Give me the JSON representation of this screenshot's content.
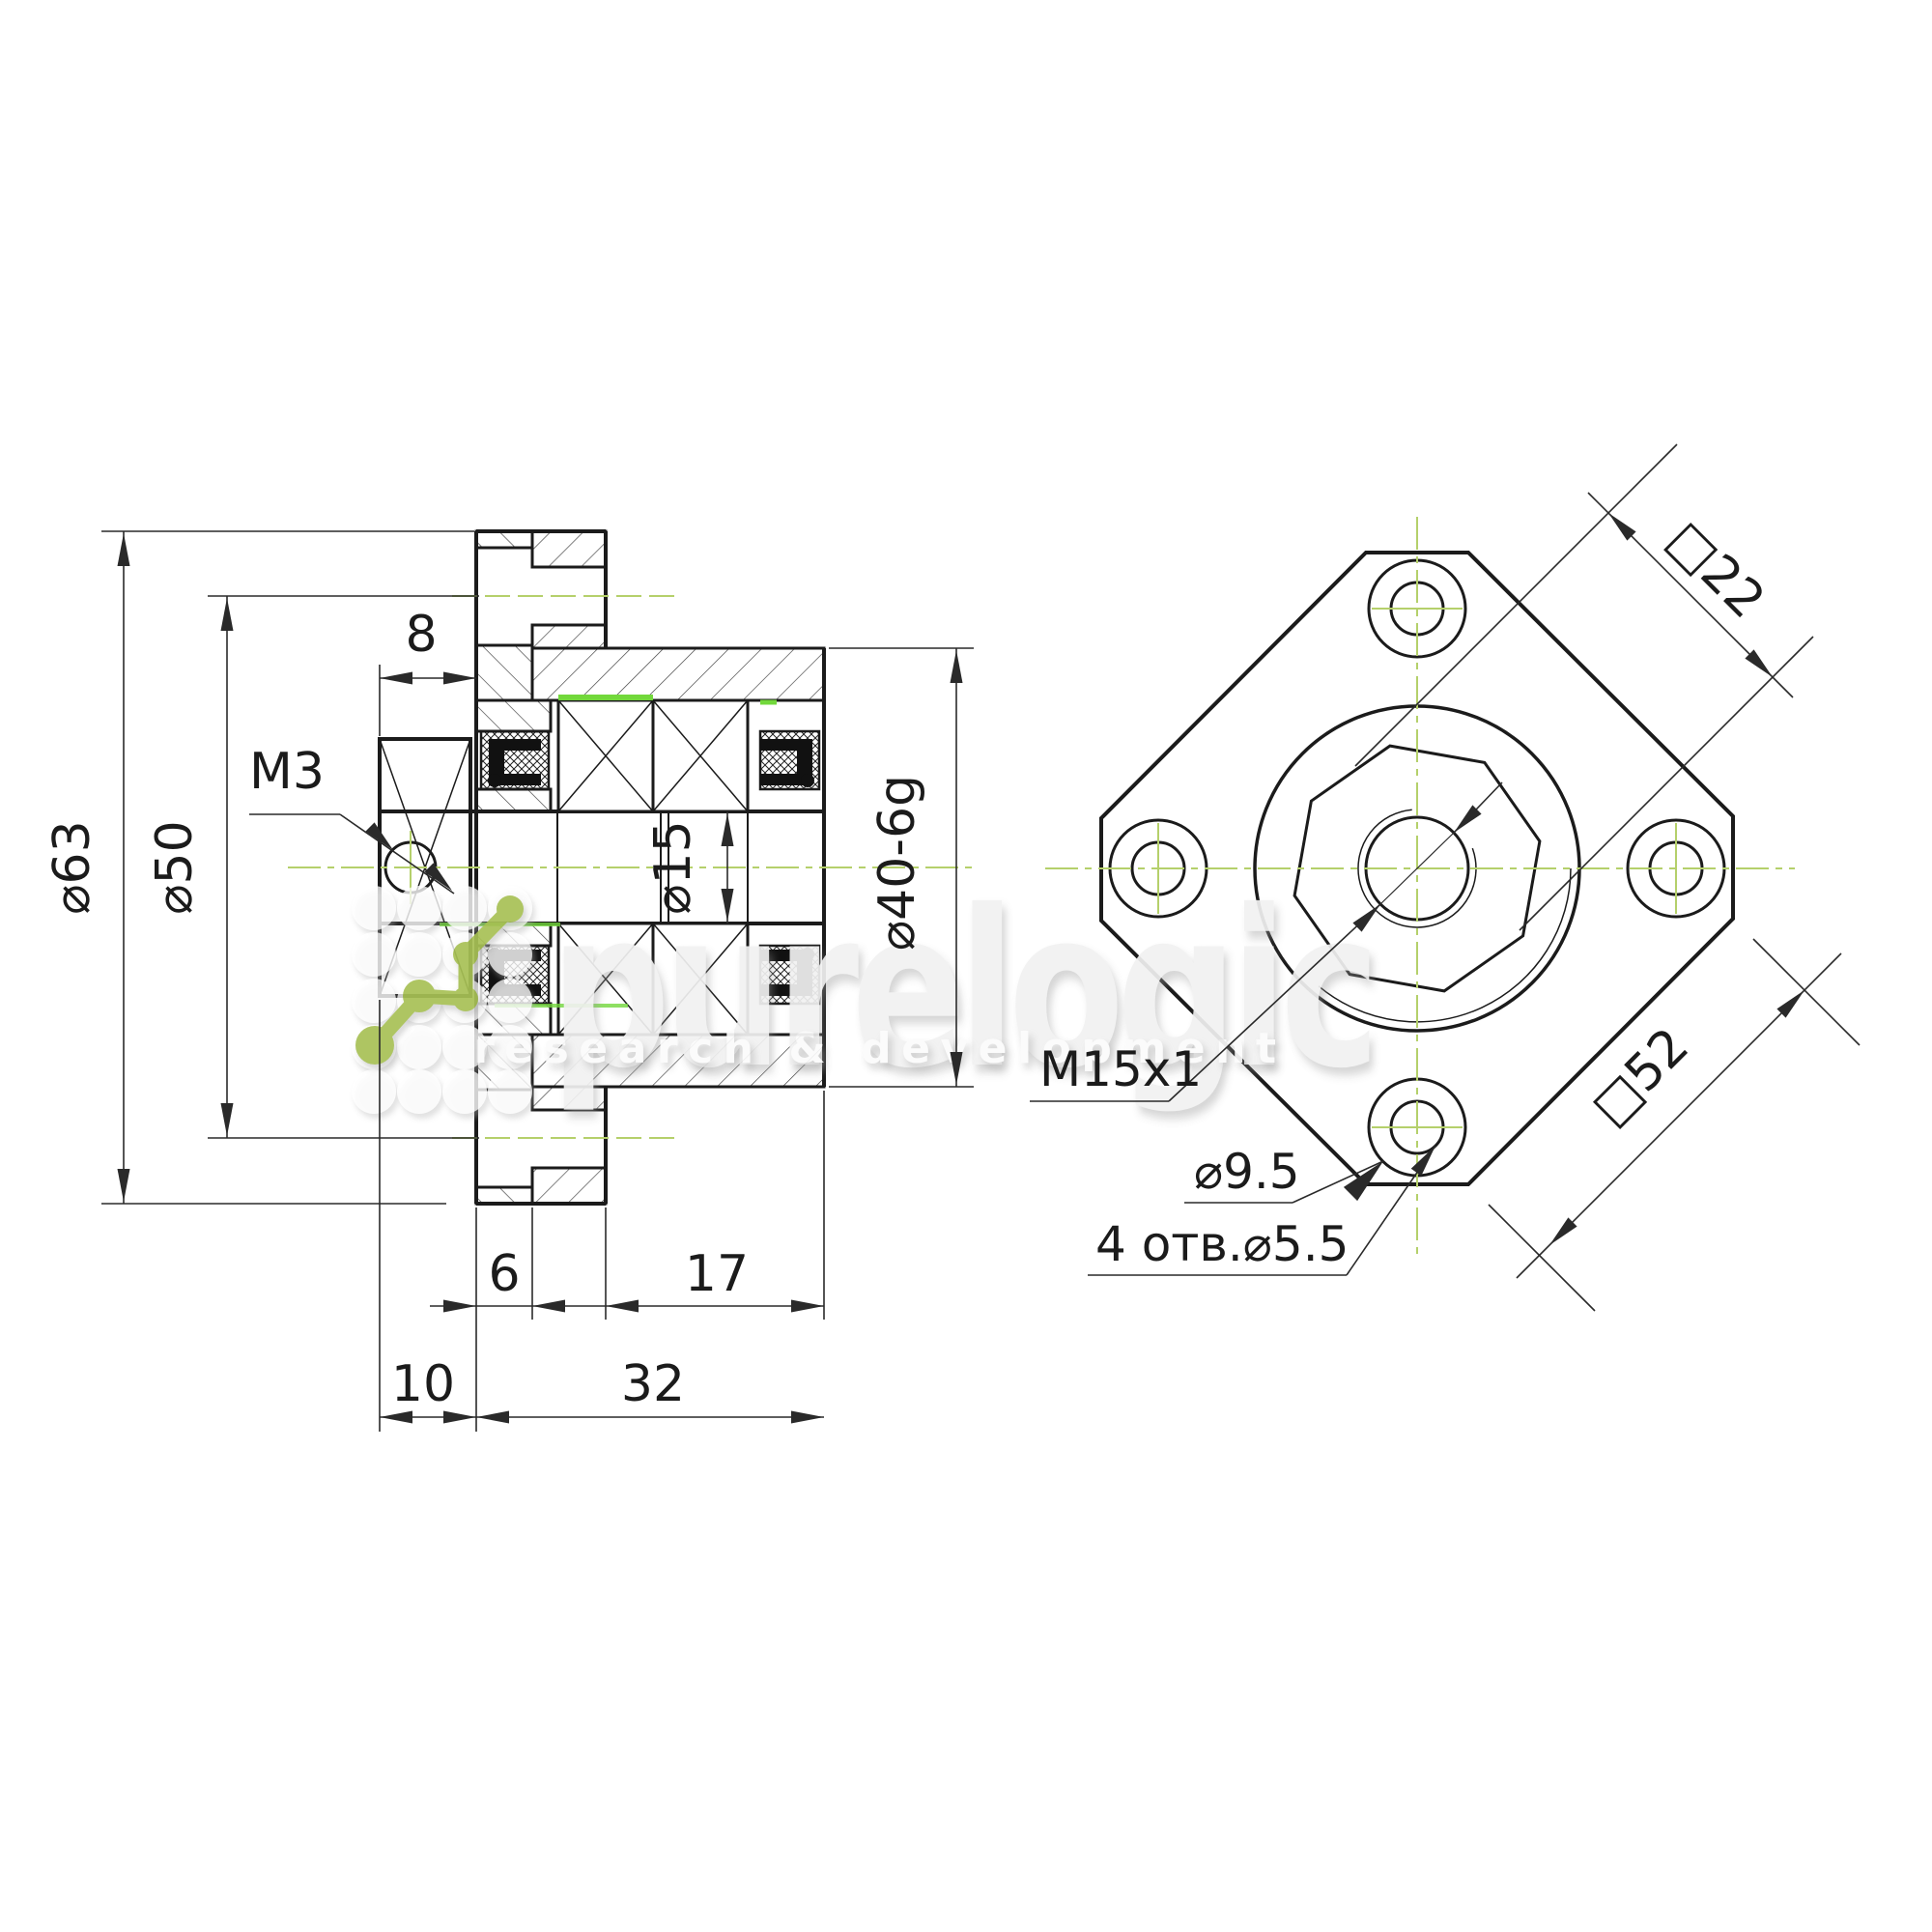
{
  "colors": {
    "background": "#ffffff",
    "line": "#1b1b1b",
    "dimension": "#2a2a2a",
    "centerline_green": "#b5d06b",
    "highlight_green": "#72d83b",
    "molecule_green": "#a8c155",
    "watermark_gray": "#f1f1f1"
  },
  "section_view": {
    "dia63": "⌀63",
    "dia50": "⌀50",
    "width8": "8",
    "set_screw": "M3",
    "bore": "⌀15",
    "pilot": "⌀40-6g",
    "flange_thickness": "6",
    "pilot_length": "17",
    "front_length": "10",
    "total_length": "32"
  },
  "front_view": {
    "nut_flats": "□22",
    "flange_square": "□52",
    "thread": "M15x1",
    "counterbore": "⌀9.5",
    "mount_holes": "4 отв.⌀5.5"
  },
  "watermark": {
    "wordmark": "purelogic",
    "tagline": "research & development"
  }
}
